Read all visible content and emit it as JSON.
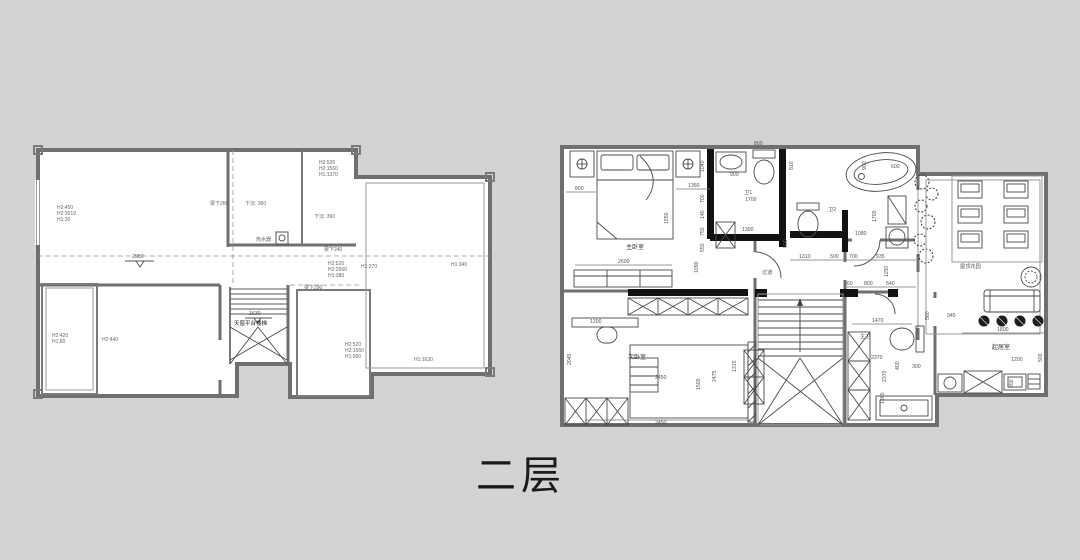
{
  "title": "二层",
  "left": {
    "h_main": [
      "H2:450",
      "H2:3519",
      "H1:30"
    ],
    "level_main": "2980",
    "beam_a": "梁下260",
    "sunken_a": "下沉: 360",
    "sunken_b": "下沉: 360",
    "heater": "热水器",
    "h_tr": [
      "H2:526",
      "H2:1560",
      "H1:1370"
    ],
    "beam_b": "梁下240",
    "h_mid": [
      "H2:520",
      "H2:2560",
      "H1:380"
    ],
    "h_270": "H1:270",
    "beam_c": "梁下290",
    "h_340": "H1:340",
    "h_bl": [
      "H2:420",
      "H1:60"
    ],
    "h_440": "H2:440",
    "stair_level": "1630",
    "stair_label": "天窗平台楼梯",
    "h_br": [
      "H2:520",
      "H2:1560",
      "H1:990"
    ],
    "h_1630": "H1:1630"
  },
  "right": {
    "rooms": {
      "master": "主卧室",
      "bath1": "卫1",
      "bath2": "卫2",
      "terrace": "屋顶花园",
      "corridor": "过道",
      "bedroom2": "次卧室",
      "master_bath": "主卫",
      "living": "起居室"
    },
    "dims": {
      "top800": "800",
      "m800": "800",
      "m1360": "1360",
      "m2600": "2600",
      "m1550": "1550",
      "c1040": "1040",
      "c700": "700",
      "c140": "140",
      "c750": "750",
      "c550": "550",
      "c1090": "1090",
      "b900": "900",
      "b810": "810",
      "b1700": "1700",
      "b1300": "1300",
      "b500": "500",
      "l1080": "1080",
      "l1700": "1700",
      "h1310": "1310",
      "h500": "500",
      "h700": "700",
      "h935": "935",
      "h1150": "1150",
      "g360": "360",
      "g800": "800",
      "g540": "540",
      "t900": "900",
      "t600": "600",
      "r1200": "1200",
      "r2045": "2045",
      "r2450a": "2450",
      "r1500": "1500",
      "r2450b": "2450",
      "r2475": "2475",
      "r1315": "1315",
      "k1470": "1470",
      "k560": "560",
      "k2370a": "2370",
      "k2370b": "2370",
      "k1360": "1360",
      "v945": "945",
      "v1800": "1800",
      "v1200": "1200",
      "v500": "500",
      "v550": "550",
      "v400": "400",
      "v300": "300"
    }
  }
}
